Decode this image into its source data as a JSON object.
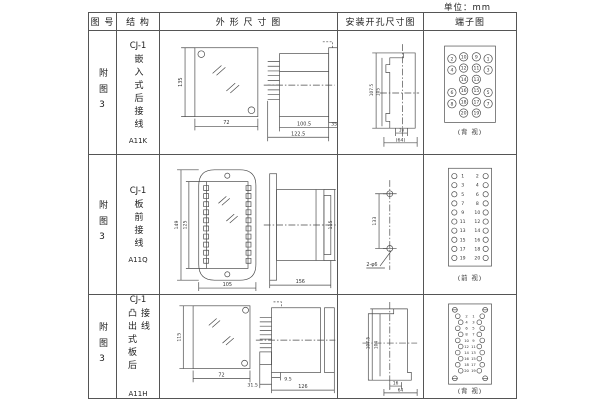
{
  "unit": "单位：mm",
  "colors": {
    "line": "#4a4a4a",
    "border": "#555555",
    "text": "#222222",
    "background": "#ffffff"
  },
  "header": [
    "图 号",
    "结 构",
    "外 形 尺 寸 图",
    "安装开孔尺寸图",
    "端子图"
  ],
  "rows": [
    {
      "fig_no": "附图3",
      "structure": {
        "series": "CJ-1",
        "name": "嵌入式后接线",
        "model": "A11K"
      },
      "outline": {
        "h": "135",
        "w": "72",
        "d1": "100.5",
        "d2": "122.5",
        "d3": "35"
      },
      "install": {
        "v1": "107.5",
        "v2": "105",
        "h1": "16",
        "h2": "(64)"
      },
      "terminal": {
        "caption": "(背 视)",
        "g": [
          [
            "2",
            "10",
            "9",
            "1"
          ],
          [
            "4",
            "12",
            "11",
            "3"
          ],
          [
            "14",
            "13"
          ],
          [
            "6",
            "16",
            "15",
            "5"
          ],
          [
            "8",
            "18",
            "17",
            "7"
          ],
          [
            "20",
            "19"
          ]
        ]
      }
    },
    {
      "fig_no": "附图3",
      "structure": {
        "series": "CJ-1",
        "name": "板前接线",
        "model": "A11Q"
      },
      "outline": {
        "h1": "149",
        "h2": "125",
        "w": "105",
        "len": "156",
        "side_h": "115"
      },
      "install": {
        "pitch": "133",
        "holes": "2-φ6"
      },
      "terminal": {
        "caption": "(前 视)",
        "left": [
          "1",
          "3",
          "5",
          "7",
          "9",
          "11",
          "13",
          "15",
          "17",
          "19"
        ],
        "right": [
          "2",
          "4",
          "6",
          "8",
          "10",
          "12",
          "14",
          "16",
          "18",
          "20"
        ]
      }
    },
    {
      "fig_no": "附图3",
      "structure": {
        "series": "CJ-1",
        "name": "凸出式板后接线",
        "model": "A11H"
      },
      "outline": {
        "h": "115",
        "w": "72",
        "d1": "31.5",
        "d2": "9.5",
        "d3": "126"
      },
      "install": {
        "v1": "107.5",
        "v2": "104",
        "h1": "16",
        "h2": "64"
      },
      "terminal": {
        "caption": "(背 视)",
        "left": [
          "2",
          "4",
          "6",
          "8",
          "10",
          "12",
          "14",
          "16",
          "18",
          "20"
        ],
        "right": [
          "1",
          "3",
          "5",
          "7",
          "9",
          "11",
          "13",
          "15",
          "17",
          "19"
        ]
      }
    }
  ]
}
